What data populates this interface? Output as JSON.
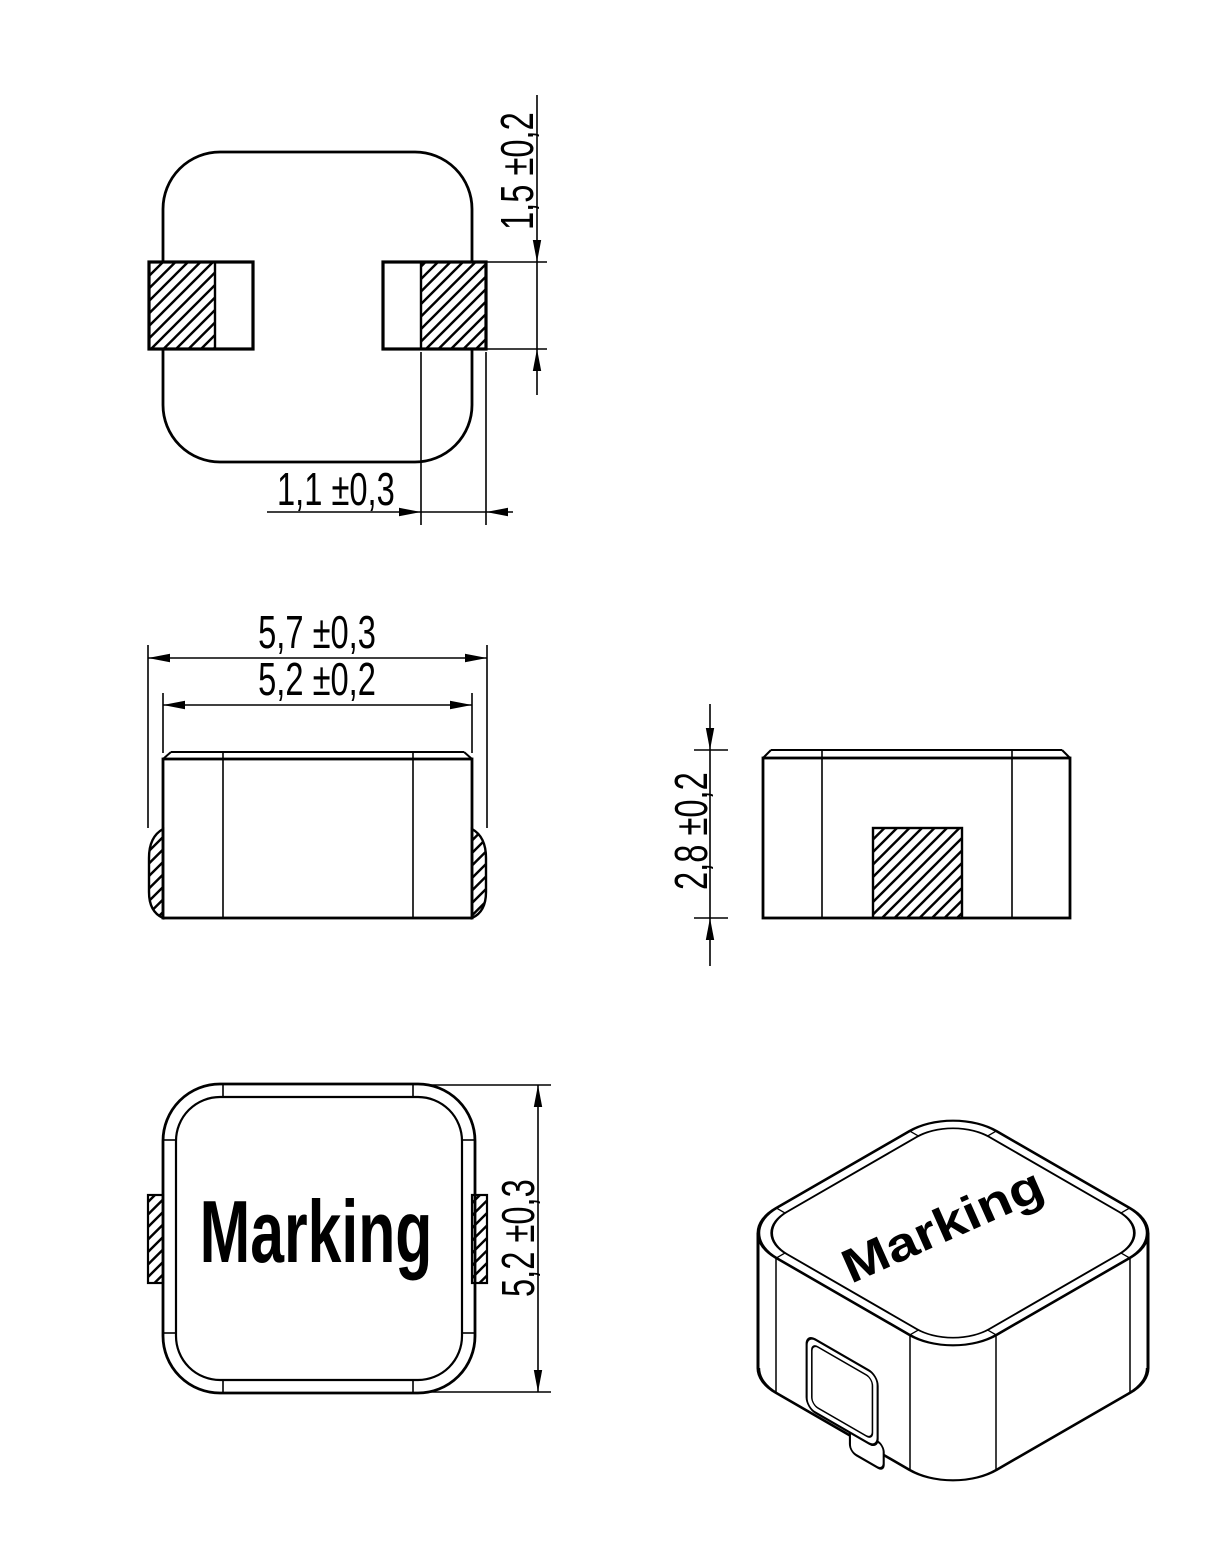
{
  "page": {
    "background": "#ffffff",
    "line_color": "#000000"
  },
  "labels": {
    "pad_height": "1,5 ±0,2",
    "pad_width": "1,1 ±0,3",
    "overall_width": "5,7 ±0,3",
    "body_width": "5,2 ±0,2",
    "body_height": "2,8 ±0,2",
    "body_depth": "5,2 ±0,3",
    "marking_top": "Marking",
    "marking_iso": "Marking"
  }
}
